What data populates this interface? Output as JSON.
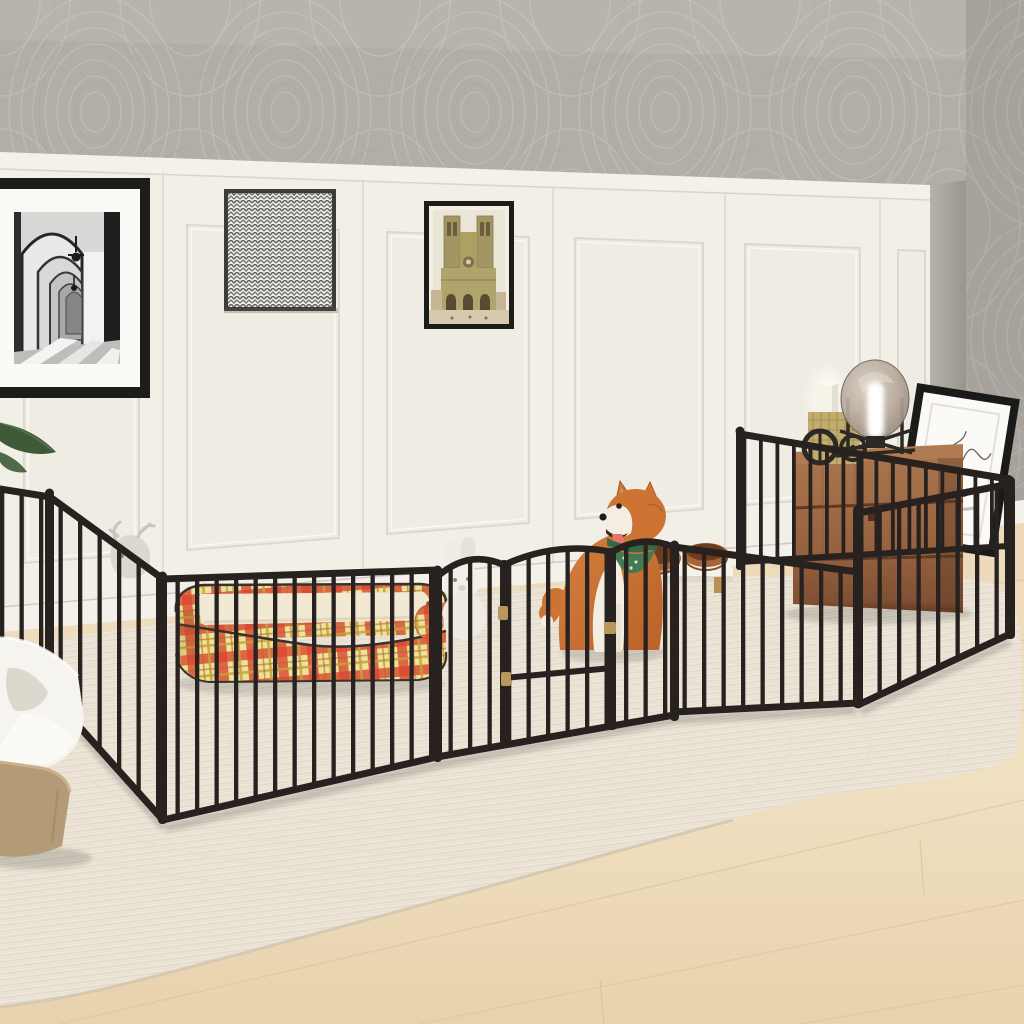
{
  "scene": {
    "type": "product lifestyle photograph",
    "product": "Black metal pet playpen, 16-panel with arched walk-through gate",
    "setting": "Living room: gray moire wallpaper, white wainscoting panels, light wood floor, cream braided rug",
    "subjects": [
      "shiba-inu dog with green bandana",
      "plaid bolster dog bed",
      "elevated double pet bowls",
      "plush bunny toy",
      "plush moose toy",
      "plaid ball toy",
      "litter box",
      "wooden storage crate",
      "glass globe lamp",
      "lit pillar candle",
      "gear book decor",
      "leaning sketch frame",
      "three wall artworks",
      "plant leaves"
    ],
    "wall_art": [
      {
        "name": "black-and-white arched corridor photograph",
        "frame": "thin black with white mat"
      },
      {
        "name": "gray chevron zigzag abstract art",
        "frame": "thin dark gray"
      },
      {
        "name": "notre-dame cathedral watercolor",
        "frame": "thin black"
      }
    ],
    "pen": {
      "color": "matte black",
      "gate": "arched top door with brass hinges and latch",
      "layout": "long rectangle along the room with side return sections"
    },
    "dog": {
      "breed": "shiba inu",
      "pose": "sitting, facing left, mouth open",
      "accessory": "green bandana"
    }
  },
  "palette": {
    "wallpaper_base": "#b2aea7",
    "wallpaper_line": "#c7c3bc",
    "wainscot": "#f2efe7",
    "trim": "#f4f1ea",
    "wall_shadow": "#d9d5cc",
    "floor_light": "#f0e2c5",
    "floor_dark": "#e0cba6",
    "rug": "#ece5d7",
    "rug_row": "#e1d8c7",
    "fence": "#27221f",
    "dog_orange": "#cd7434",
    "dog_cream": "#f3ede2",
    "bandana": "#417951",
    "tongue": "#e5766b",
    "bed_plaid_bg": "#eae498",
    "bed_plaid_red": "#d8472f",
    "bed_plaid_accent": "#c99f3f",
    "bed_cushion": "#f1e9d4",
    "bed_piping": "#38322d",
    "crate": "#9a6743",
    "crate_dark": "#6f4730",
    "bowl": "#8a4f28",
    "stand": "#f5f2ea",
    "leg_wood": "#c59b66",
    "litter_white": "#f6f4ee",
    "litter_tan": "#b49b77",
    "candle": "#f6f3e9",
    "gold": "#c3ad6e",
    "hinge": "#b9975a",
    "gear": "#2c2824",
    "lamp_glass": "#b7a99c",
    "leaf": "#3f5a37",
    "frame_black": "#1c1c1b",
    "mat": "#fbfaf7"
  }
}
